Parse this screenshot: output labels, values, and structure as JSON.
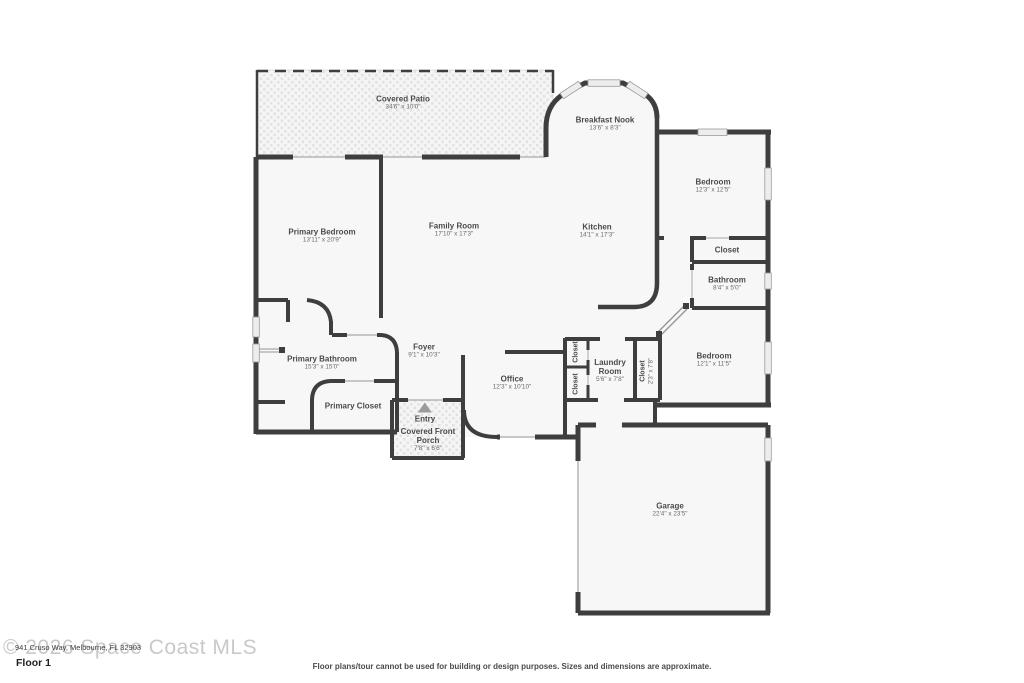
{
  "watermark": "© 2026 Space Coast MLS",
  "address_line": "941 Cruso Way, Melbourne, FL 32903",
  "floor_label": "Floor 1",
  "disclaimer": "Floor plans/tour cannot be used for building or design purposes. Sizes and dimensions are approximate.",
  "colors": {
    "wall": "#3e3e3e",
    "room_fill": "#f7f7f7",
    "label_text": "#4a4a4a",
    "watermark": "#c9c9c9",
    "window": "#ededed"
  },
  "rooms": {
    "covered_patio": {
      "name": "Covered Patio",
      "dims": "34'6\" x 10'0\""
    },
    "breakfast_nook": {
      "name": "Breakfast Nook",
      "dims": "13'6\" x 8'3\""
    },
    "bedroom1": {
      "name": "Bedroom",
      "dims": "12'3\" x 12'5\""
    },
    "primary_bedroom": {
      "name": "Primary Bedroom",
      "dims": "13'11\" x 20'9\""
    },
    "family_room": {
      "name": "Family Room",
      "dims": "17'10\" x 17'3\""
    },
    "kitchen": {
      "name": "Kitchen",
      "dims": "14'1\" x 17'3\""
    },
    "closet_bed1": {
      "name": "Closet",
      "dims": ""
    },
    "bathroom": {
      "name": "Bathroom",
      "dims": "8'4\" x 5'0\""
    },
    "primary_bathroom": {
      "name": "Primary Bathroom",
      "dims": "15'3\" x 15'0\""
    },
    "foyer": {
      "name": "Foyer",
      "dims": "9'1\" x 10'3\""
    },
    "office": {
      "name": "Office",
      "dims": "12'3\" x 10'10\""
    },
    "closet_hall_a": {
      "name": "Closet",
      "dims": ""
    },
    "closet_hall_b": {
      "name": "Closet",
      "dims": ""
    },
    "laundry_room": {
      "name": "Laundry Room",
      "dims": "5'6\" x 7'8\""
    },
    "closet_bed2": {
      "name": "Closet",
      "dims": "2'3\" x 7'8\""
    },
    "bedroom2": {
      "name": "Bedroom",
      "dims": "12'1\" x 11'5\""
    },
    "primary_closet": {
      "name": "Primary Closet",
      "dims": ""
    },
    "entry": {
      "name": "Entry",
      "dims": ""
    },
    "front_porch": {
      "name": "Covered Front Porch",
      "dims": "7'8\" x 6'6\""
    },
    "garage": {
      "name": "Garage",
      "dims": "22'4\" x 23'5\""
    }
  }
}
